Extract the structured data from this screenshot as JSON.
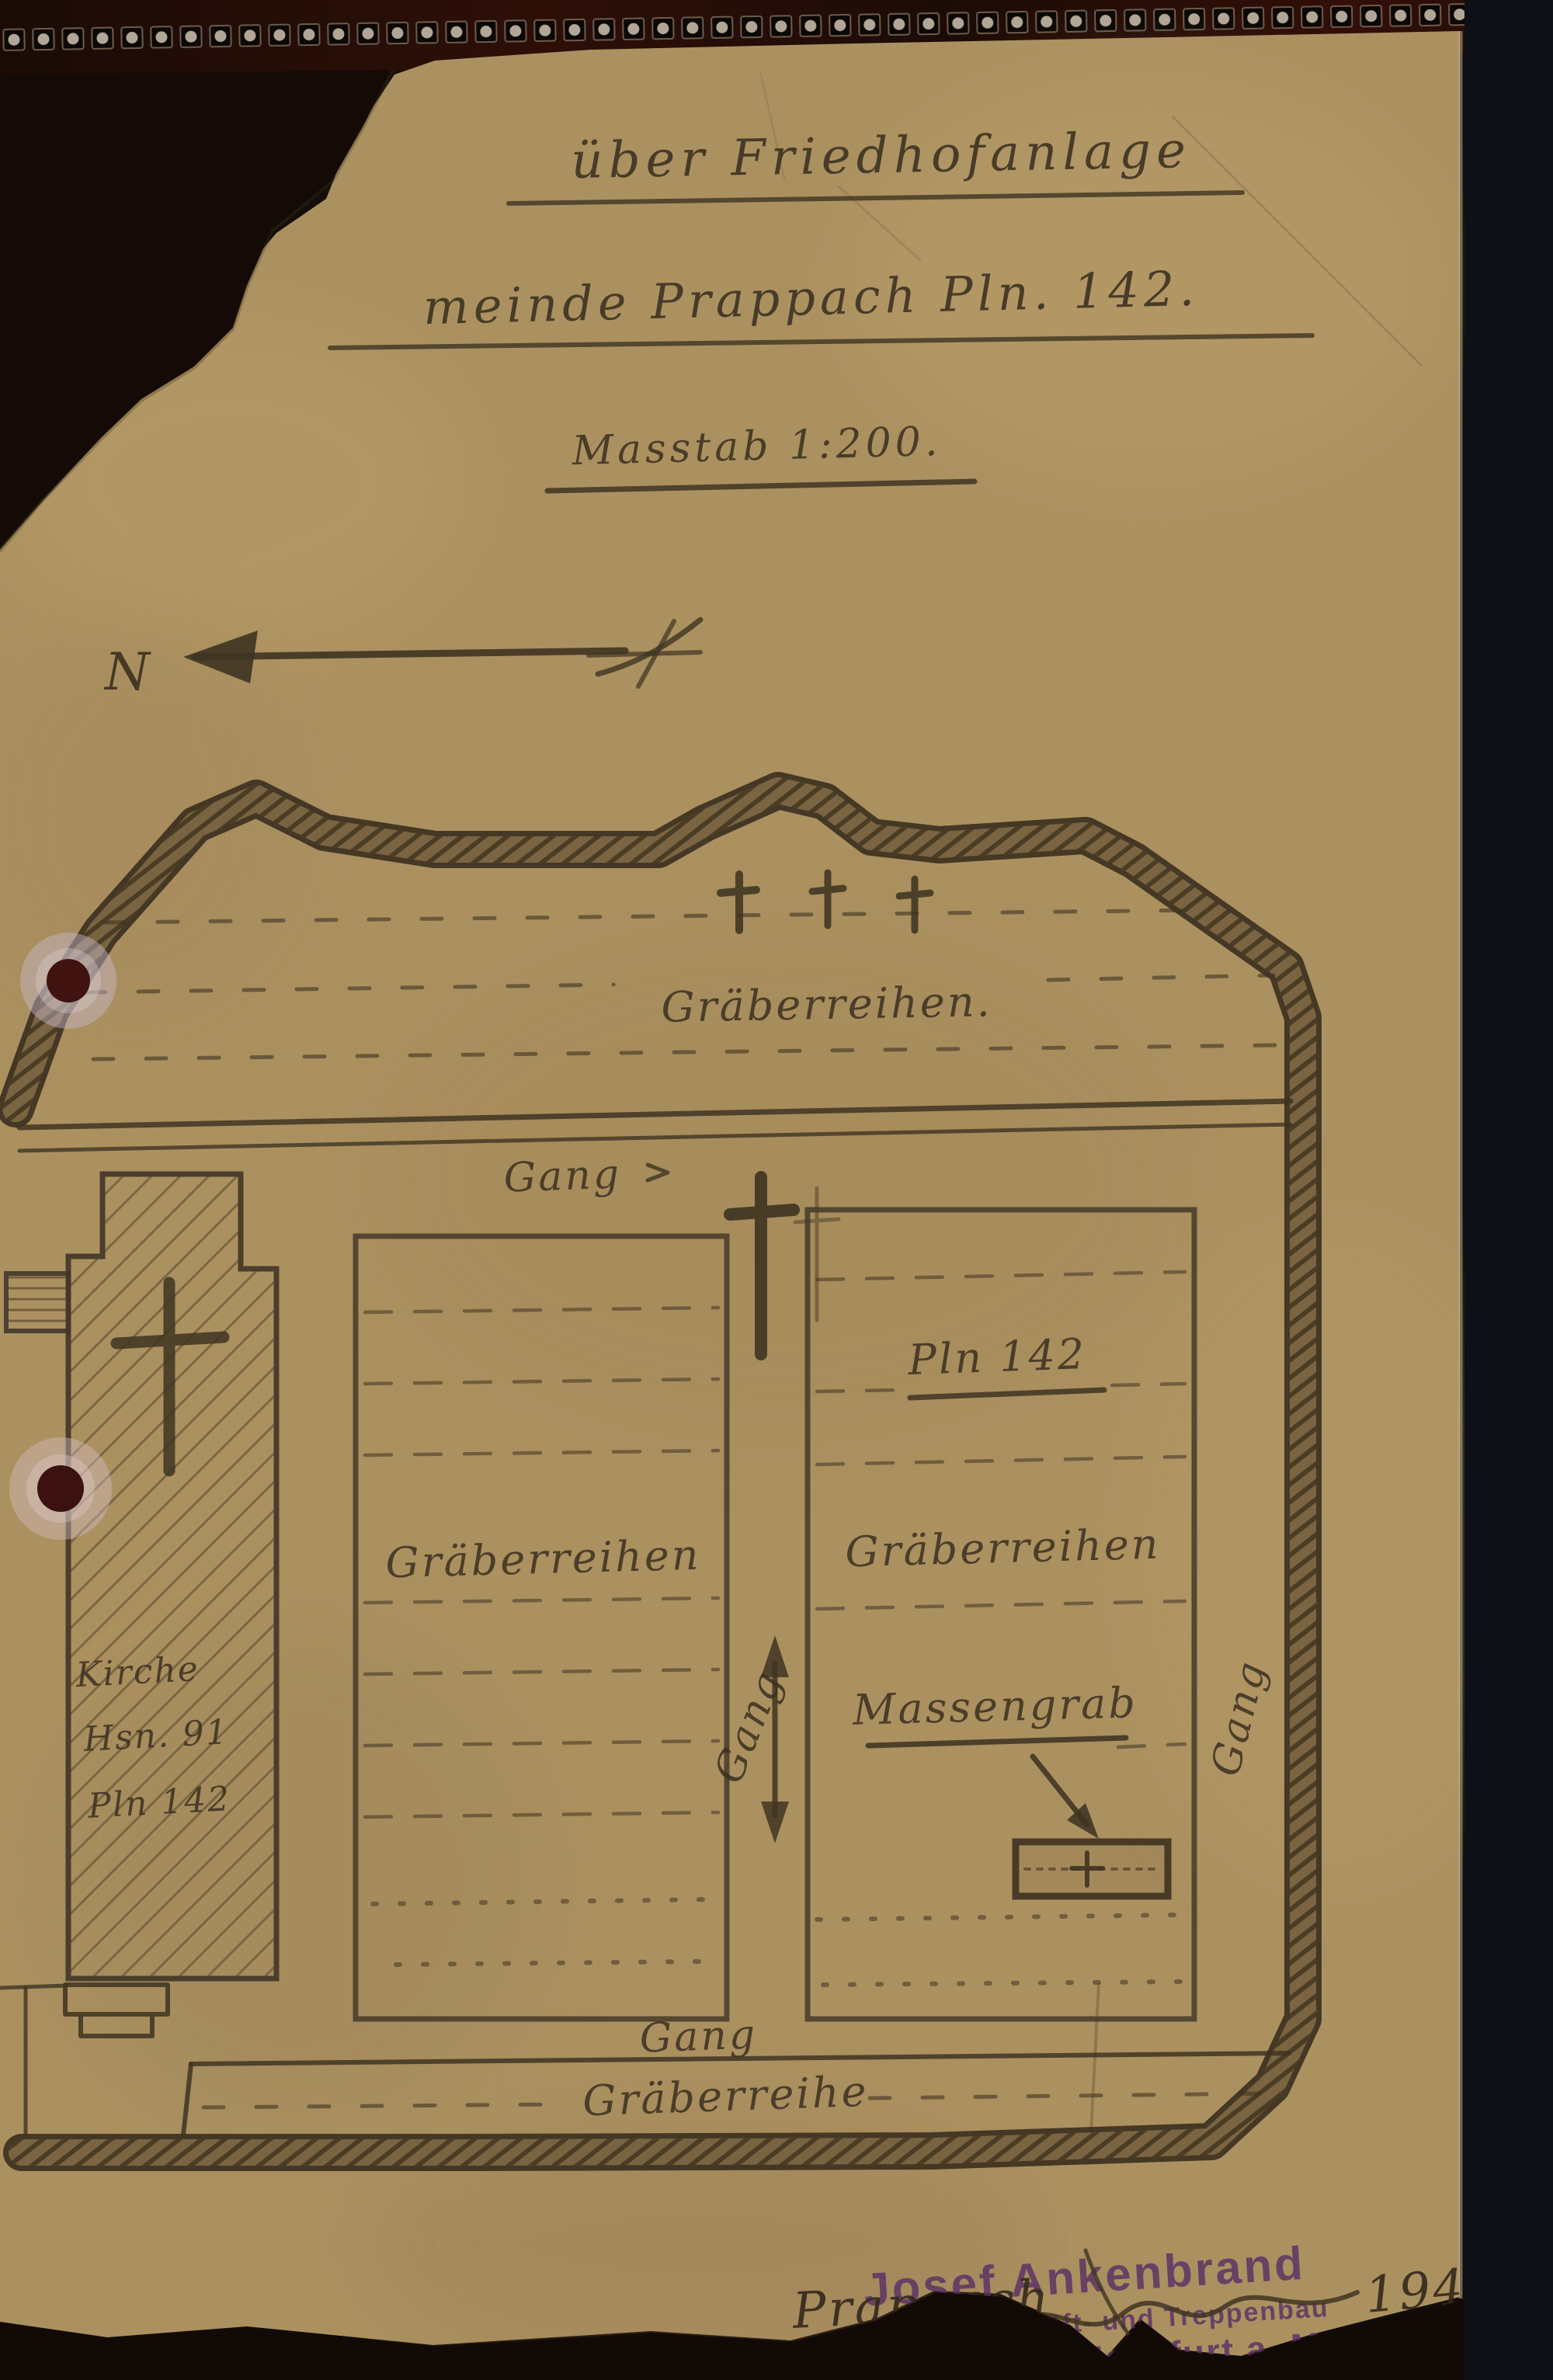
{
  "document": {
    "title_line1": "über Friedhofanlage",
    "title_line2": "meinde Prappach Pln. 142.",
    "scale_line": "Masstab 1:200.",
    "north_label": "N"
  },
  "plan": {
    "top_rows_label": "Gräberreihen.",
    "gang_top": "Gang",
    "left_block_label": "Gräberreihen",
    "right_block_plan_no": "Pln 142",
    "right_block_label": "Gräberreihen",
    "mass_grave_label": "Massengrab",
    "gang_center": "Gang",
    "gang_right": "Gang",
    "gang_bottom": "Gang",
    "bottom_row_label": "Gräberreihe",
    "church": {
      "name": "Kirche",
      "house_no": "Hsn. 91",
      "plan_no": "Pln 142"
    }
  },
  "footer": {
    "handwritten_place": "Prappach",
    "handwritten_year": "1946.",
    "stamp": {
      "name": "Josef Ankenbrand",
      "trade": "Zimmergeschäft- und Treppenbau",
      "address": "Prappach b. Hassfurt a. M."
    }
  },
  "colors": {
    "background": "#140d08",
    "paper": "#ac9160",
    "ink": "#3f3422",
    "stamp_purple": "#5a3166",
    "hole_maroon": "#401310",
    "perforation_strip": "#2e0f08"
  }
}
